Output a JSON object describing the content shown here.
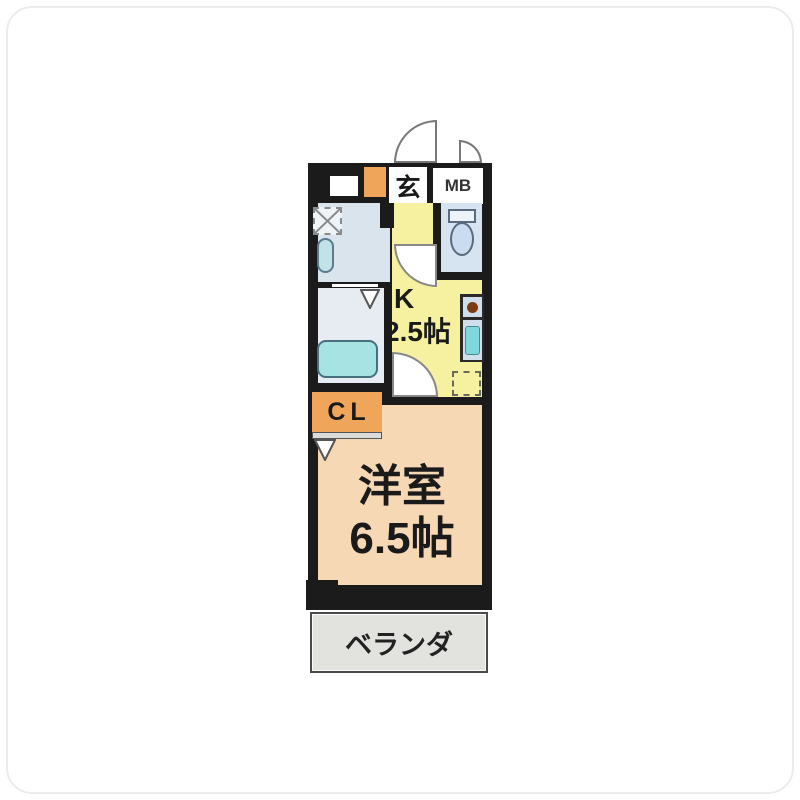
{
  "floorplan": {
    "title": "1K apartment floor plan",
    "labels": {
      "genkan": "玄",
      "meter_box": "MB",
      "kitchen_type": "K",
      "kitchen_size": "2.5帖",
      "closet": "CL",
      "main_room_name": "洋室",
      "main_room_size": "6.5帖",
      "balcony": "ベランダ"
    },
    "colors": {
      "wall": "#1b1b1b",
      "kitchen": "#f5f1a1",
      "main_room": "#f6d8b4",
      "closet": "#efa55a",
      "washroom": "#d9e4ed",
      "bathroom": "#e7ecf2",
      "toilet_room": "#d6e3f0",
      "toilet_bowl": "#c9dcf0",
      "bathtub": "#a8e3e3",
      "balcony": "#e2e2de",
      "counter": "#cfe0ec",
      "sink": "#7fd8dc",
      "burner": "#7a3c10",
      "door_line": "#777777"
    },
    "icons": {
      "entrance_door": "entrance-door-swing-icon",
      "mb_door": "meter-box-door-swing-icon",
      "toilet": "toilet-icon",
      "bathtub": "bathtub-icon",
      "washer": "washing-machine-space-icon",
      "vanity": "vanity-basin-icon",
      "fridge": "refrigerator-space-icon",
      "burner": "stove-burner-icon",
      "sink": "kitchen-sink-icon"
    }
  }
}
